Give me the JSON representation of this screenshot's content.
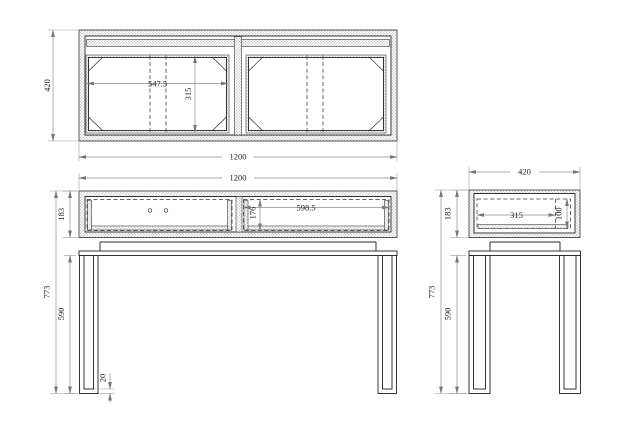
{
  "drawing": {
    "views": {
      "top": {
        "overall_depth": "420",
        "overall_width": "1200",
        "compartment_width": "547.5",
        "compartment_depth": "315"
      },
      "front": {
        "overall_width": "1200",
        "top_box_height": "183",
        "overall_height": "773",
        "leg_height": "590",
        "foot_thickness": "20",
        "drawer_inner_width": "598.5",
        "drawer_inner_height": "176"
      },
      "side": {
        "overall_depth": "420",
        "top_box_height": "183",
        "overall_height": "773",
        "leg_height": "590",
        "inner_width": "315",
        "inner_height": "100"
      }
    },
    "colors": {
      "line": "#2b2b2b",
      "dimension": "#8d8d8d",
      "text": "#1f1f1f",
      "background": "#ffffff"
    }
  }
}
